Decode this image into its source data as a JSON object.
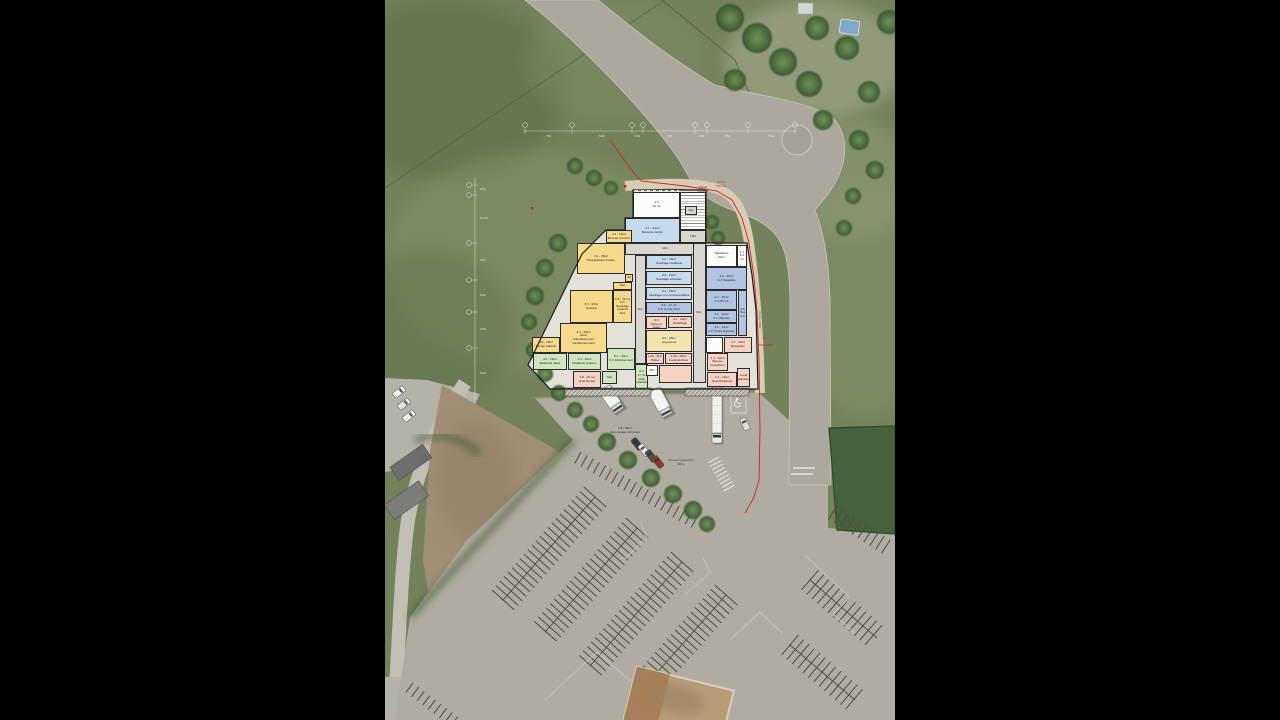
{
  "title": "Plan masse — cuisine centrale sur photo aérienne",
  "colors": {
    "yellow": "#f6d98a",
    "blue": "#c5daed",
    "lav": "#b3c3e3",
    "pink": "#f5d2c2",
    "green": "#cfe5bd",
    "cream": "#f2e3b0",
    "white": "#fcfcf9",
    "gray": "#d8d6cf",
    "boundary_red": "#cc2222",
    "road": "#aca89d",
    "paved": "#b0aca1",
    "stripe": "#4d4a41"
  },
  "plan": {
    "outline": "248,190 321,190 321,243 362,243 367,275 371,310 373,389 165,389 143,365 197,254 221,230 240,230 240,218 248,218",
    "rooms": [
      {
        "id": "lt-1-7",
        "x": 248,
        "y": 192,
        "w": 47,
        "h": 26,
        "c": "white",
        "t": "1.7\n24 m²"
      },
      {
        "id": "stairs",
        "x": 295,
        "y": 192,
        "w": 26,
        "h": 38,
        "c": "white",
        "t": "",
        "stairs": true
      },
      {
        "id": "sas-hall",
        "x": 300,
        "y": 206,
        "w": 12,
        "h": 9,
        "c": "gray",
        "t": "Sas"
      },
      {
        "id": "hall",
        "x": 295,
        "y": 230,
        "w": 26,
        "h": 13,
        "c": "gray",
        "t": "Hall"
      },
      {
        "id": "reserve-seche",
        "x": 240,
        "y": 218,
        "w": 55,
        "h": 25,
        "c": "blue",
        "t": "2.1 - 41m²\nRéserve sèche"
      },
      {
        "id": "bureau-chef",
        "x": 221,
        "y": 230,
        "w": 26,
        "h": 13,
        "c": "yellow",
        "t": "3.1 - 16m²\nBureau du Chef"
      },
      {
        "id": "circ-h",
        "x": 240,
        "y": 243,
        "w": 81,
        "h": 12,
        "c": "gray",
        "t": "Circ."
      },
      {
        "id": "prep-froides",
        "x": 192,
        "y": 243,
        "w": 48,
        "h": 31,
        "c": "yellow",
        "t": "3.2 - 45m²\nPréparations froides"
      },
      {
        "id": "cf-small",
        "x": 240,
        "y": 274,
        "w": 8,
        "h": 8,
        "c": "yellow",
        "t": "CF"
      },
      {
        "id": "sas-cuisine",
        "x": 228,
        "y": 282,
        "w": 19,
        "h": 8,
        "c": "yellow",
        "t": "Sas"
      },
      {
        "id": "cuisson",
        "x": 185,
        "y": 290,
        "w": 43,
        "h": 33,
        "c": "yellow",
        "t": "3.3 - 93m²\nCuisson"
      },
      {
        "id": "cf-stock-pf",
        "x": 228,
        "y": 290,
        "w": 19,
        "h": 33,
        "c": "yellow",
        "t": "3.5 - 12 m²\nC.F\nStockage\nproduits finis"
      },
      {
        "id": "zone-refroid",
        "x": 175,
        "y": 323,
        "w": 47,
        "h": 30,
        "c": "yellow",
        "t": "3.4 - 28m²\nZone\nrefroidissement\nconditionnement"
      },
      {
        "id": "plonge-batterie",
        "x": 147,
        "y": 337,
        "w": 28,
        "h": 16,
        "c": "yellow",
        "t": "3.6 - 16m²\nPlonge batterie"
      },
      {
        "id": "materiels-sales",
        "x": 148,
        "y": 353,
        "w": 34,
        "h": 17,
        "c": "green",
        "t": "4.1 - 16m²\nMatériels sales"
      },
      {
        "id": "materiels-propres",
        "x": 183,
        "y": 353,
        "w": 33,
        "h": 17,
        "c": "green",
        "t": "4.4 - 16m²\nMatériels propres"
      },
      {
        "id": "cf-allotissement",
        "x": 222,
        "y": 348,
        "w": 28,
        "h": 22,
        "c": "green",
        "t": "8.1 - 40m²\nC.F Allotissement"
      },
      {
        "id": "quai-retour",
        "x": 188,
        "y": 371,
        "w": 28,
        "h": 17,
        "c": "pink",
        "t": "1.5 - 31 m²\nQuai Retour"
      },
      {
        "id": "sas-exped",
        "x": 217,
        "y": 371,
        "w": 15,
        "h": 13,
        "c": "green",
        "t": "Sas"
      },
      {
        "id": "quai-expedition",
        "x": 250,
        "y": 364,
        "w": 13,
        "h": 27,
        "c": "green",
        "t": "6.2\n17 m²\nQuai\nExpédition"
      },
      {
        "id": "circ-v1",
        "x": 250,
        "y": 255,
        "w": 11,
        "h": 109,
        "c": "gray",
        "t": "Circ."
      },
      {
        "id": "stock-materiels",
        "x": 261,
        "y": 255,
        "w": 46,
        "h": 14,
        "c": "blue",
        "t": "2.4 - 16m²\nStockage matériels"
      },
      {
        "id": "stock-entretien",
        "x": 261,
        "y": 271,
        "w": 46,
        "h": 14,
        "c": "blue",
        "t": "2.3 - 12m²\nStockage entretien"
      },
      {
        "id": "stock-non-cons",
        "x": 261,
        "y": 287,
        "w": 46,
        "h": 13,
        "c": "blue",
        "t": "2.2 - 16m²\nStockage non consommables"
      },
      {
        "id": "cf-circuit-court",
        "x": 261,
        "y": 302,
        "w": 46,
        "h": 12,
        "c": "lav",
        "t": "3.6 - 17 m²\nC.F circuit court"
      },
      {
        "id": "cf-mise-en-place",
        "x": 261,
        "y": 316,
        "w": 21,
        "h": 13,
        "c": "pink",
        "t": "4.3\nC.F\nMise en place"
      },
      {
        "id": "deboitage",
        "x": 283,
        "y": 316,
        "w": 24,
        "h": 12,
        "c": "pink",
        "t": "4.1 - 12m²\nDéboîtage"
      },
      {
        "id": "legumerie",
        "x": 261,
        "y": 330,
        "w": 46,
        "h": 22,
        "c": "cream",
        "t": "4.2 - 25m²\nLégumerie"
      },
      {
        "id": "huiles",
        "x": 261,
        "y": 353,
        "w": 18,
        "h": 11,
        "c": "pink",
        "t": "1.4a - 5m²\nHuiles"
      },
      {
        "id": "local-dechets",
        "x": 280,
        "y": 353,
        "w": 27,
        "h": 11,
        "c": "pink",
        "t": "1.4b - 20m²\nLocal déchets"
      },
      {
        "id": "wc",
        "x": 261,
        "y": 365,
        "w": 12,
        "h": 11,
        "c": "white",
        "t": "WC"
      },
      {
        "id": "vestiaire",
        "x": 274,
        "y": 365,
        "w": 33,
        "h": 18,
        "c": "pink",
        "t": ""
      },
      {
        "id": "circ-v2",
        "x": 308,
        "y": 243,
        "w": 13,
        "h": 140,
        "c": "gray",
        "t": "Circ."
      },
      {
        "id": "sanitaires",
        "x": 321,
        "y": 245,
        "w": 31,
        "h": 22,
        "c": "white",
        "t": "Sanitaires\n10m²"
      },
      {
        "id": "lt-small",
        "x": 352,
        "y": 245,
        "w": 10,
        "h": 22,
        "c": "white",
        "t": "1.7\n5.1 m²"
      },
      {
        "id": "cf-negative",
        "x": 321,
        "y": 267,
        "w": 41,
        "h": 23,
        "c": "lav",
        "t": "2.4 - 20m²\nC.F Négative"
      },
      {
        "id": "cf-bof",
        "x": 321,
        "y": 290,
        "w": 31,
        "h": 20,
        "c": "lav",
        "t": "2.3 - 15m²\nC.F B.O.F"
      },
      {
        "id": "cf-viandes",
        "x": 321,
        "y": 310,
        "w": 31,
        "h": 13,
        "c": "lav",
        "t": "2.2 - 12m²\nC.F Viandes"
      },
      {
        "id": "cf-fruits-legumes",
        "x": 321,
        "y": 323,
        "w": 31,
        "h": 13,
        "c": "lav",
        "t": "2.1 - 13m²\nC.F Fruits légumes"
      },
      {
        "id": "sas-cf",
        "x": 353,
        "y": 290,
        "w": 9,
        "h": 46,
        "c": "lav",
        "t": "2.5\nSas\nC.F"
      },
      {
        "id": "local-tech",
        "x": 321,
        "y": 337,
        "w": 17,
        "h": 16,
        "c": "white",
        "t": ""
      },
      {
        "id": "reception",
        "x": 339,
        "y": 337,
        "w": 28,
        "h": 16,
        "c": "pink",
        "t": "1.2 - 32m²\nRéception"
      },
      {
        "id": "bureau-receptions",
        "x": 322,
        "y": 353,
        "w": 21,
        "h": 18,
        "c": "pink",
        "t": "1.3 - 12m²\nBureau\nréceptions"
      },
      {
        "id": "quai-livraisons",
        "x": 322,
        "y": 372,
        "w": 30,
        "h": 15,
        "c": "pink",
        "t": "1.1 - 16m²\nQuai livraisons"
      },
      {
        "id": "local-palettes",
        "x": 352,
        "y": 368,
        "w": 13,
        "h": 19,
        "c": "pink",
        "t": "Local\npalettes"
      }
    ]
  },
  "site": {
    "texts": [
      {
        "t": "Parvis\n(minéral)",
        "x": 318,
        "y": 186,
        "s": 3,
        "c": "#444444",
        "r": 0
      },
      {
        "t": "Accès\nPiétons",
        "x": 336,
        "y": 181,
        "s": 3,
        "c": "#cc2222",
        "r": 0
      },
      {
        "t": "Rampe PMR",
        "x": 374,
        "y": 318,
        "s": 3,
        "c": "#666666",
        "r": 90
      },
      {
        "t": "Rampe PMR",
        "x": 338,
        "y": 212,
        "s": 3,
        "c": "#777777",
        "r": 48
      },
      {
        "t": "1.8 - 98m²\nZone lavage véhicules",
        "x": 240,
        "y": 427,
        "s": 3,
        "c": "#333333",
        "r": 0
      },
      {
        "t": "Aire de manoeuvre\n50 m",
        "x": 296,
        "y": 459,
        "s": 3,
        "c": "#333333",
        "r": 0
      },
      {
        "t": "3 m",
        "x": 380,
        "y": 337,
        "s": 3,
        "c": "#cc2222",
        "r": 0
      }
    ],
    "dims": {
      "top": {
        "y": 131,
        "x1": 138,
        "x2": 412,
        "bubbles": [
          140,
          187,
          247,
          258,
          310,
          322,
          363,
          410
        ],
        "segs": [
          {
            "t": "7.50",
            "x": 163
          },
          {
            "t": "5.30",
            "x": 217
          },
          {
            "t": "2.50",
            "x": 252
          },
          {
            "t": "7.50",
            "x": 284
          },
          {
            "t": "2.50",
            "x": 316
          },
          {
            "t": "7.50",
            "x": 342
          },
          {
            "t": "7.50",
            "x": 386
          }
        ]
      },
      "left": {
        "x": 90,
        "y1": 178,
        "y2": 400,
        "bubbles": [
          185,
          195,
          243,
          280,
          312,
          348
        ],
        "segs": [
          {
            "t": "2.50",
            "y": 190
          },
          {
            "t": "12.00",
            "y": 219
          },
          {
            "t": "9.00",
            "y": 261
          },
          {
            "t": "8.00",
            "y": 296
          },
          {
            "t": "9.00",
            "y": 330
          },
          {
            "t": "5.00",
            "y": 374
          }
        ]
      }
    },
    "trees": [
      [
        190,
        166,
        8
      ],
      [
        209,
        178,
        8
      ],
      [
        226,
        188,
        7
      ],
      [
        173,
        243,
        9
      ],
      [
        160,
        268,
        9
      ],
      [
        150,
        296,
        9
      ],
      [
        144,
        322,
        8
      ],
      [
        149,
        350,
        8
      ],
      [
        160,
        374,
        8
      ],
      [
        174,
        393,
        8
      ],
      [
        190,
        410,
        8
      ],
      [
        206,
        424,
        8
      ],
      [
        327,
        222,
        7
      ],
      [
        333,
        238,
        7
      ],
      [
        222,
        442,
        9
      ],
      [
        243,
        460,
        9
      ],
      [
        266,
        478,
        9
      ],
      [
        288,
        494,
        9
      ],
      [
        308,
        510,
        9
      ],
      [
        322,
        524,
        8
      ],
      [
        474,
        140,
        10
      ],
      [
        490,
        170,
        9
      ],
      [
        468,
        196,
        8
      ],
      [
        459,
        228,
        8
      ],
      [
        345,
        18,
        14
      ],
      [
        372,
        38,
        15
      ],
      [
        398,
        62,
        14
      ],
      [
        424,
        84,
        13
      ],
      [
        350,
        80,
        11
      ],
      [
        432,
        28,
        12
      ],
      [
        462,
        48,
        12
      ],
      [
        484,
        92,
        11
      ],
      [
        504,
        22,
        12
      ],
      [
        438,
        120,
        10
      ]
    ],
    "stripe_rows": [
      {
        "x1": 210,
        "y1": 497,
        "x2": 118,
        "y2": 600,
        "len": 15,
        "gap": 6,
        "double": true
      },
      {
        "x1": 252,
        "y1": 528,
        "x2": 160,
        "y2": 632,
        "len": 15,
        "gap": 6,
        "double": true
      },
      {
        "x1": 297,
        "y1": 562,
        "x2": 205,
        "y2": 666,
        "len": 15,
        "gap": 6,
        "double": true
      },
      {
        "x1": 341,
        "y1": 595,
        "x2": 262,
        "y2": 684,
        "len": 15,
        "gap": 6,
        "double": true
      },
      {
        "x1": 196,
        "y1": 452,
        "x2": 318,
        "y2": 519,
        "len": 13,
        "gap": 7,
        "double": false,
        "side": 1
      },
      {
        "x1": 452,
        "y1": 506,
        "x2": 510,
        "y2": 543,
        "len": 16,
        "gap": 7,
        "double": false,
        "side": 1
      },
      {
        "x1": 425,
        "y1": 580,
        "x2": 492,
        "y2": 638,
        "len": 13,
        "gap": 7,
        "double": true
      },
      {
        "x1": 405,
        "y1": 645,
        "x2": 470,
        "y2": 700,
        "len": 13,
        "gap": 7,
        "double": true
      },
      {
        "x1": 28,
        "y1": 683,
        "x2": 80,
        "y2": 722,
        "len": 12,
        "gap": 7,
        "double": false,
        "side": 1
      },
      {
        "x1": 334,
        "y1": 457,
        "x2": 350,
        "y2": 486,
        "len": 12,
        "gap": 4,
        "double": false,
        "side": 1,
        "color": "#eceae2"
      }
    ],
    "trucks": [
      {
        "x": 227,
        "y": 400,
        "w": 13,
        "h": 28,
        "a": -34
      },
      {
        "x": 276,
        "y": 403,
        "w": 13,
        "h": 30,
        "a": -28
      }
    ],
    "semi": {
      "x": 332,
      "y": 410,
      "w": 10,
      "h": 46
    },
    "cars": [
      {
        "x": 252,
        "y": 444,
        "a": -38,
        "c": "#3a3a3a"
      },
      {
        "x": 259,
        "y": 450,
        "a": -38,
        "c": "#e8e8e6"
      },
      {
        "x": 266,
        "y": 456,
        "a": -38,
        "c": "#4a4a4a"
      },
      {
        "x": 273,
        "y": 462,
        "a": -38,
        "c": "#93352e"
      },
      {
        "x": 360,
        "y": 424,
        "a": -24,
        "c": "#dcdcd8"
      },
      {
        "x": 14,
        "y": 392,
        "a": 52,
        "c": "#ececea"
      },
      {
        "x": 19,
        "y": 404,
        "a": 52,
        "c": "#e2e2e0"
      },
      {
        "x": 24,
        "y": 416,
        "a": 52,
        "c": "#f0f0ee"
      }
    ]
  }
}
